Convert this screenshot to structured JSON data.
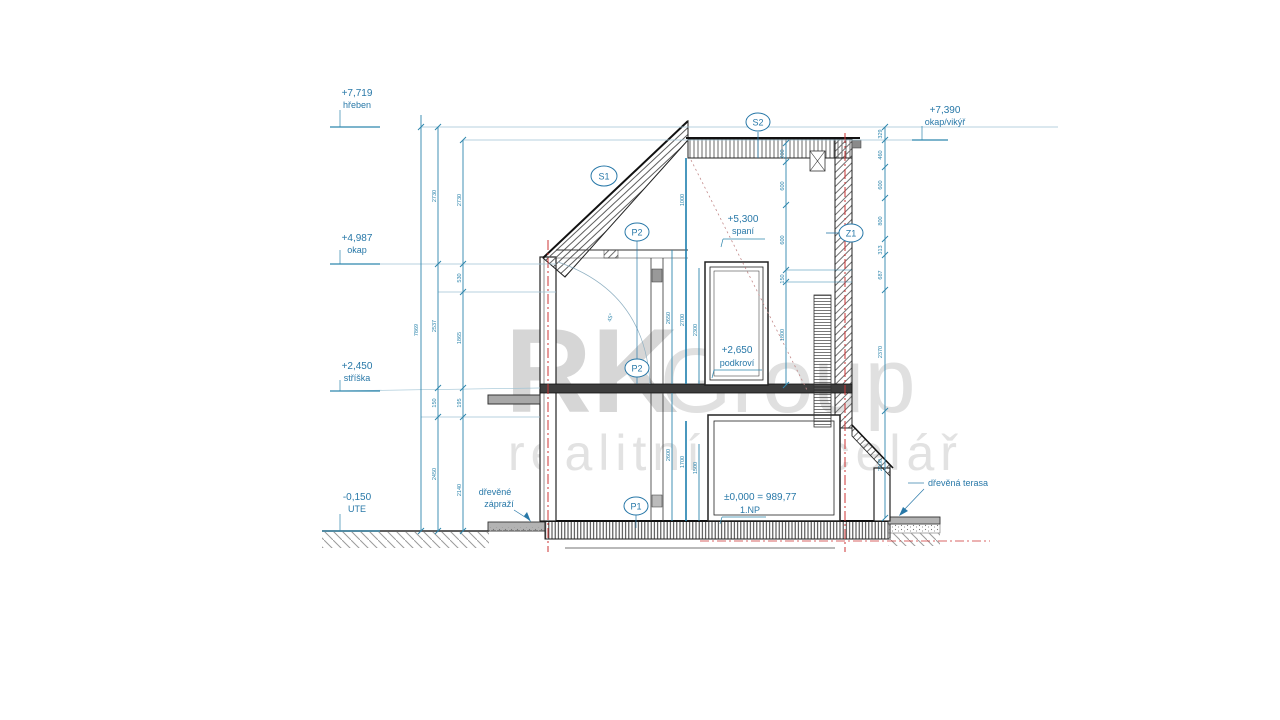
{
  "drawing": {
    "type": "architectural cross-section",
    "colors": {
      "dim_blue": "#2878a8",
      "line_dark": "#2b2b2b",
      "axis_red": "#cc3333",
      "watermark_gray": "#dcdcdc"
    },
    "watermark": {
      "part_bold": "RK",
      "part_light": "Group",
      "line2": "realitní kancelář"
    },
    "levels_left": [
      {
        "value": "+7,719",
        "label": "hřeben"
      },
      {
        "value": "+4,987",
        "label": "okap"
      },
      {
        "value": "+2,450",
        "label": "stříška"
      },
      {
        "value": "-0,150",
        "label": "UTE"
      }
    ],
    "levels_right": [
      {
        "value": "+7,390",
        "label": "okap/vikýř"
      }
    ],
    "room_levels": {
      "spani": {
        "value": "+5,300",
        "label": "spaní"
      },
      "podkrovi": {
        "value": "+2,650",
        "label": "podkroví"
      },
      "np": {
        "value": "±0,000 = 989,77",
        "label": "1.NP"
      }
    },
    "marks": {
      "s1": "S1",
      "s2": "S2",
      "p2_upper": "P2",
      "p2_lower": "P2",
      "p1": "P1",
      "z1": "Z1"
    },
    "annotations": {
      "porch_line1": "dřevěné",
      "porch_line2": "zápraží",
      "terrace": "dřevěná terasa",
      "angle": "45°"
    },
    "dims": {
      "left_total": "7869",
      "c2": [
        "2730",
        "2537",
        "150",
        "2450"
      ],
      "c3": [
        "2730",
        "530",
        "1865",
        "195",
        "2140"
      ],
      "right": [
        "329",
        "460",
        "600",
        "800",
        "313",
        "687",
        "2370",
        "2100"
      ],
      "dormer": [
        "200",
        "600",
        "600",
        "150",
        "1800"
      ],
      "attic": [
        "2650",
        "1000",
        "2700",
        "2300"
      ],
      "ground": [
        "2600",
        "1700",
        "1500"
      ]
    }
  }
}
